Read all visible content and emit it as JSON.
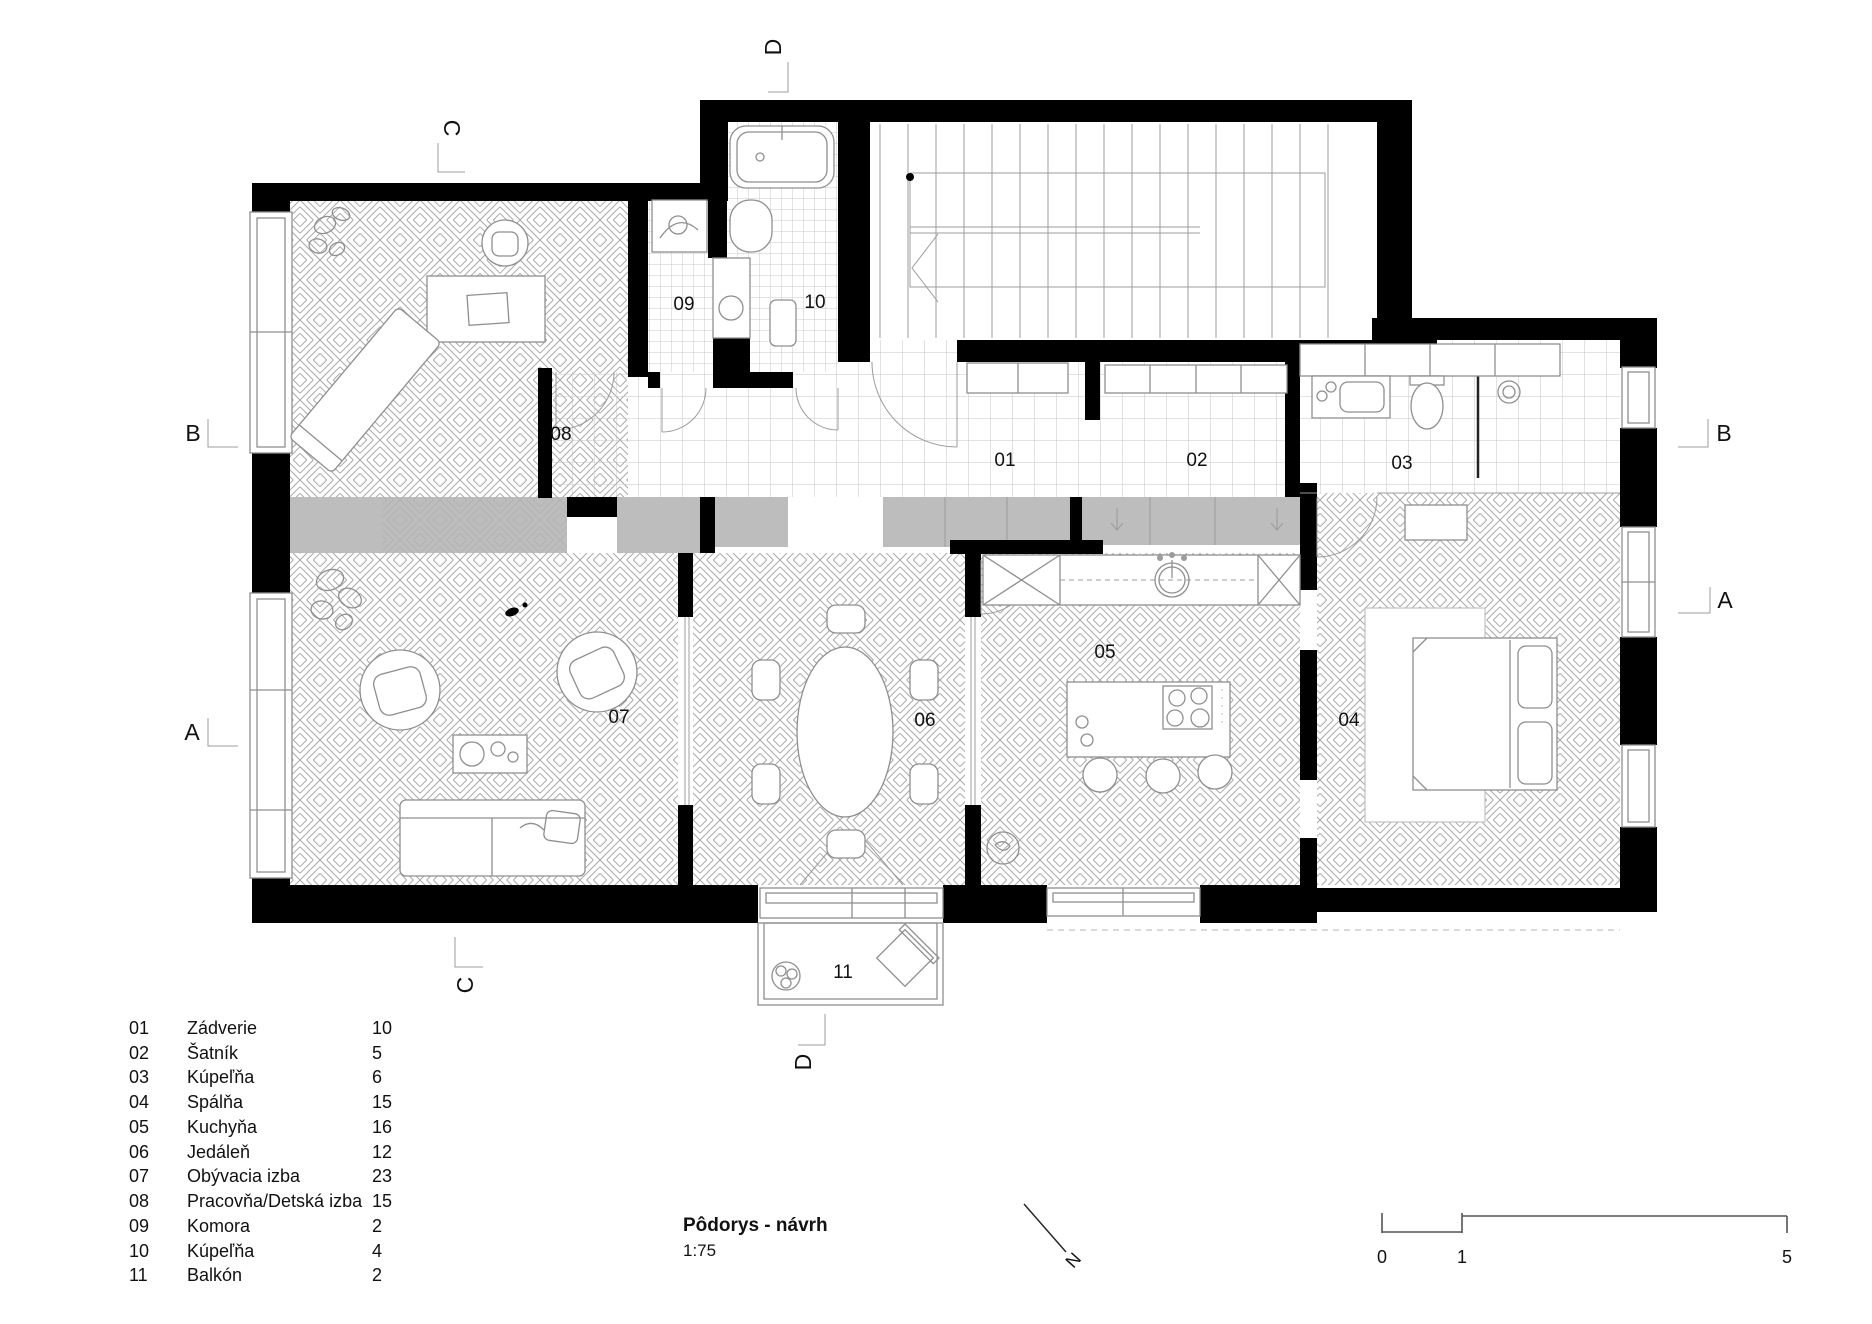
{
  "document": {
    "title": "Pôdorys - návrh",
    "scale": "1:75"
  },
  "legend": {
    "rows": [
      {
        "num": "01",
        "name": "Zádverie",
        "area": "10"
      },
      {
        "num": "02",
        "name": "Šatník",
        "area": "5"
      },
      {
        "num": "03",
        "name": "Kúpeľňa",
        "area": "6"
      },
      {
        "num": "04",
        "name": "Spálňa",
        "area": "15"
      },
      {
        "num": "05",
        "name": "Kuchyňa",
        "area": "16"
      },
      {
        "num": "06",
        "name": "Jedáleň",
        "area": "12"
      },
      {
        "num": "07",
        "name": "Obývacia izba",
        "area": "23"
      },
      {
        "num": "08",
        "name": "Pracovňa/Detská izba",
        "area": "15"
      },
      {
        "num": "09",
        "name": "Komora",
        "area": "2"
      },
      {
        "num": "10",
        "name": "Kúpeľňa",
        "area": "4"
      },
      {
        "num": "11",
        "name": "Balkón",
        "area": "2"
      }
    ]
  },
  "sections": {
    "a": "A",
    "b": "B",
    "c": "C",
    "d": "D"
  },
  "north": {
    "label": "N"
  },
  "scalebar": {
    "t0": "0",
    "t1": "1",
    "t5": "5"
  },
  "colors": {
    "wall": "#000000",
    "cabinet_gray": "#bdbdbd",
    "pattern_line": "#a0a0a0",
    "tile_line": "#c6c6c6",
    "furniture_line": "#8f8f8f",
    "text": "#111111"
  }
}
